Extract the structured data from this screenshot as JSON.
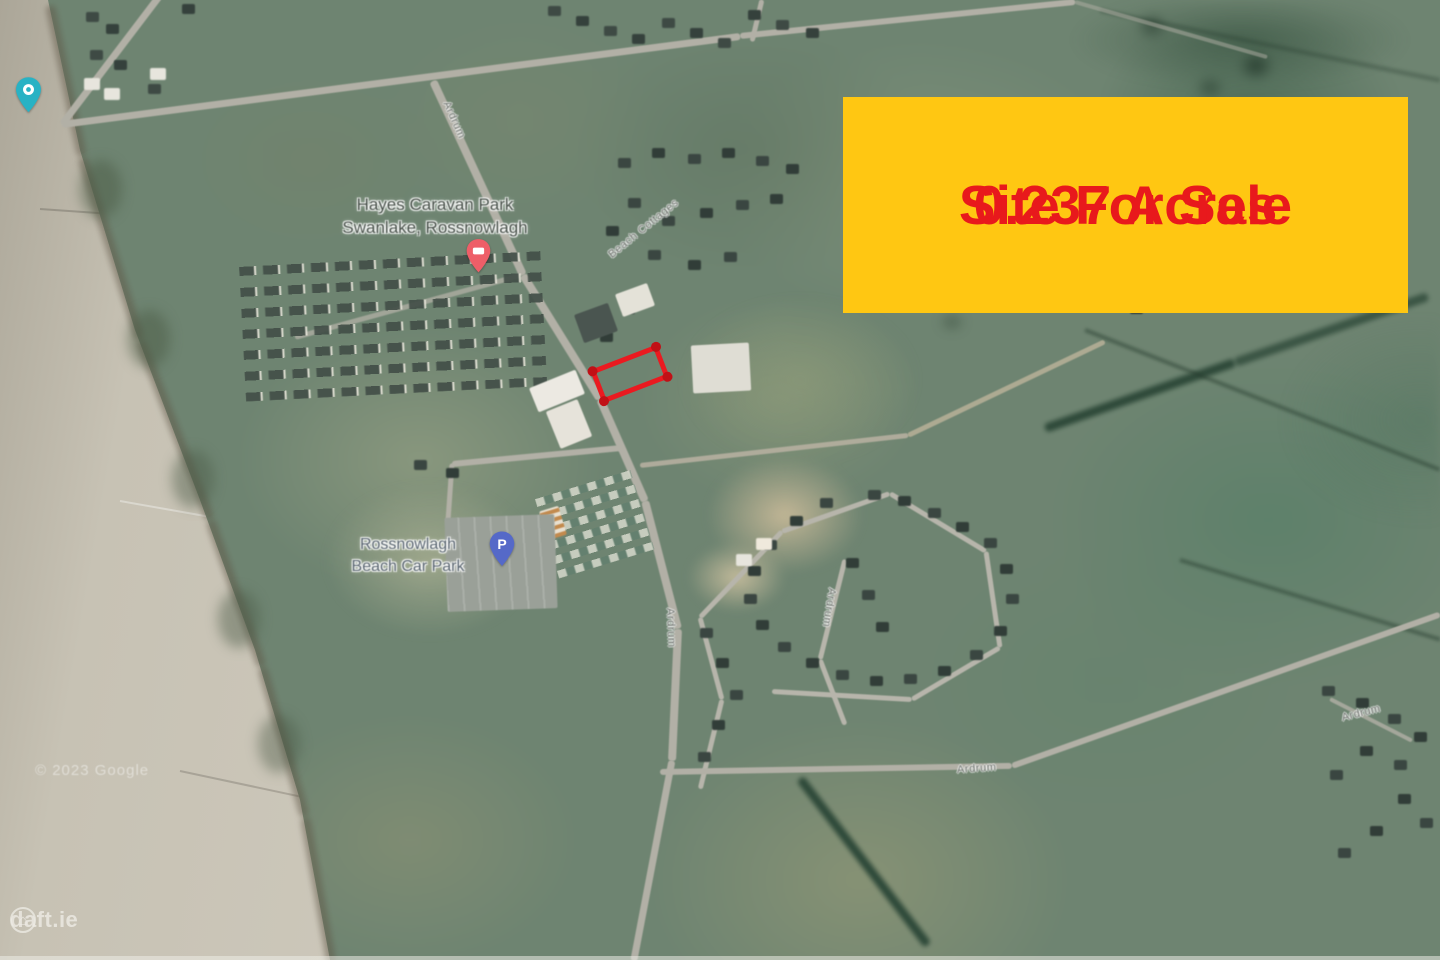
{
  "banner": {
    "line1": "Site For Sale",
    "line2": "0.237 Acres",
    "bg_color": "#FFC712",
    "text_color": "#E8191C"
  },
  "site": {
    "outline_color": "#EA1A20"
  },
  "map_labels": {
    "caravan_park": {
      "line1": "Hayes Caravan Park",
      "line2": "Swanlake, Rossnowlagh"
    },
    "beach_car_park": {
      "line1": "Rossnowlagh",
      "line2": "Beach Car Park"
    }
  },
  "road_labels": [
    {
      "text": "Ardrum"
    },
    {
      "text": "Beach Cottages"
    },
    {
      "text": "Ardrum"
    },
    {
      "text": "Ardrum"
    },
    {
      "text": "Ardrum"
    },
    {
      "text": "Ardrum"
    }
  ],
  "pins": {
    "attraction_color": "#28B2C4",
    "lodging_color": "#EE5E68",
    "parking_color": "#5569C8",
    "parking_letter": "P"
  },
  "watermarks": {
    "copyright": "© 2023 Google",
    "brand": "daft.ie"
  }
}
